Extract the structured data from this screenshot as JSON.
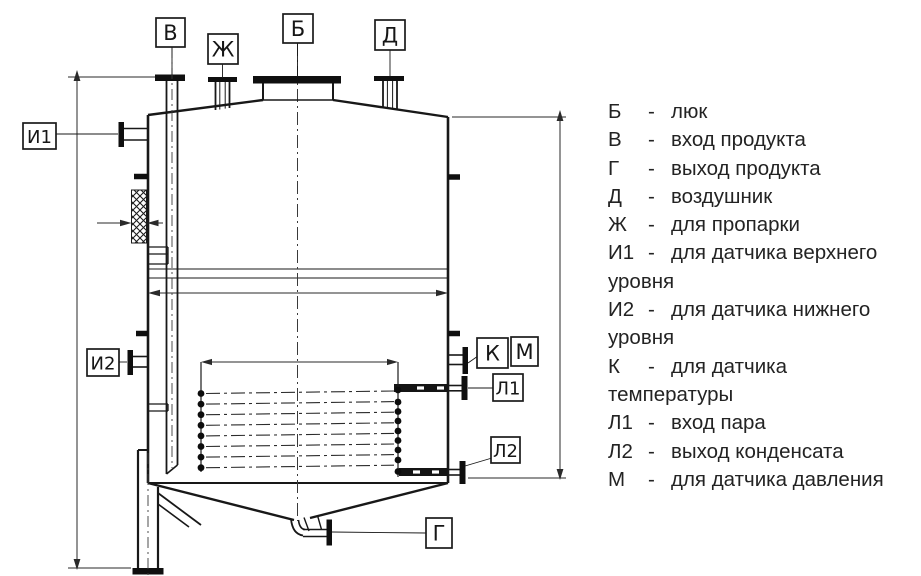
{
  "drawing": {
    "callouts": {
      "b_manhole": "Б",
      "v_product_inlet": "В",
      "zh_steaming": "Ж",
      "d_vent": "Д",
      "i1_upper_level_sensor": "И1",
      "i2_lower_level_sensor": "И2",
      "k_temperature_sensor": "К",
      "m_pressure_sensor": "М",
      "l1_steam_inlet": "Л1",
      "l2_condensate_outlet": "Л2",
      "g_product_outlet": "Г"
    }
  },
  "legend": {
    "items": [
      {
        "letter": "Б",
        "sep": "-",
        "lines": [
          "люк"
        ]
      },
      {
        "letter": "В",
        "sep": "-",
        "lines": [
          "вход продукта"
        ]
      },
      {
        "letter": "Г",
        "sep": "-",
        "lines": [
          "выход продукта"
        ]
      },
      {
        "letter": "Д",
        "sep": "-",
        "lines": [
          "воздушник"
        ]
      },
      {
        "letter": "Ж",
        "sep": "-",
        "lines": [
          "для пропарки"
        ]
      },
      {
        "letter": "И1",
        "sep": "-",
        "lines": [
          "для датчика верхнего",
          "уровня"
        ]
      },
      {
        "letter": "И2",
        "sep": "-",
        "lines": [
          "для датчика нижнего",
          "уровня"
        ]
      },
      {
        "letter": "К",
        "sep": "-",
        "lines": [
          "для датчика",
          "температуры"
        ]
      },
      {
        "letter": "Л1",
        "sep": "-",
        "lines": [
          "вход пара"
        ]
      },
      {
        "letter": "Л2",
        "sep": "-",
        "lines": [
          "выход конденсата"
        ]
      },
      {
        "letter": "М",
        "sep": "-",
        "lines": [
          "для датчика давления"
        ]
      }
    ]
  }
}
